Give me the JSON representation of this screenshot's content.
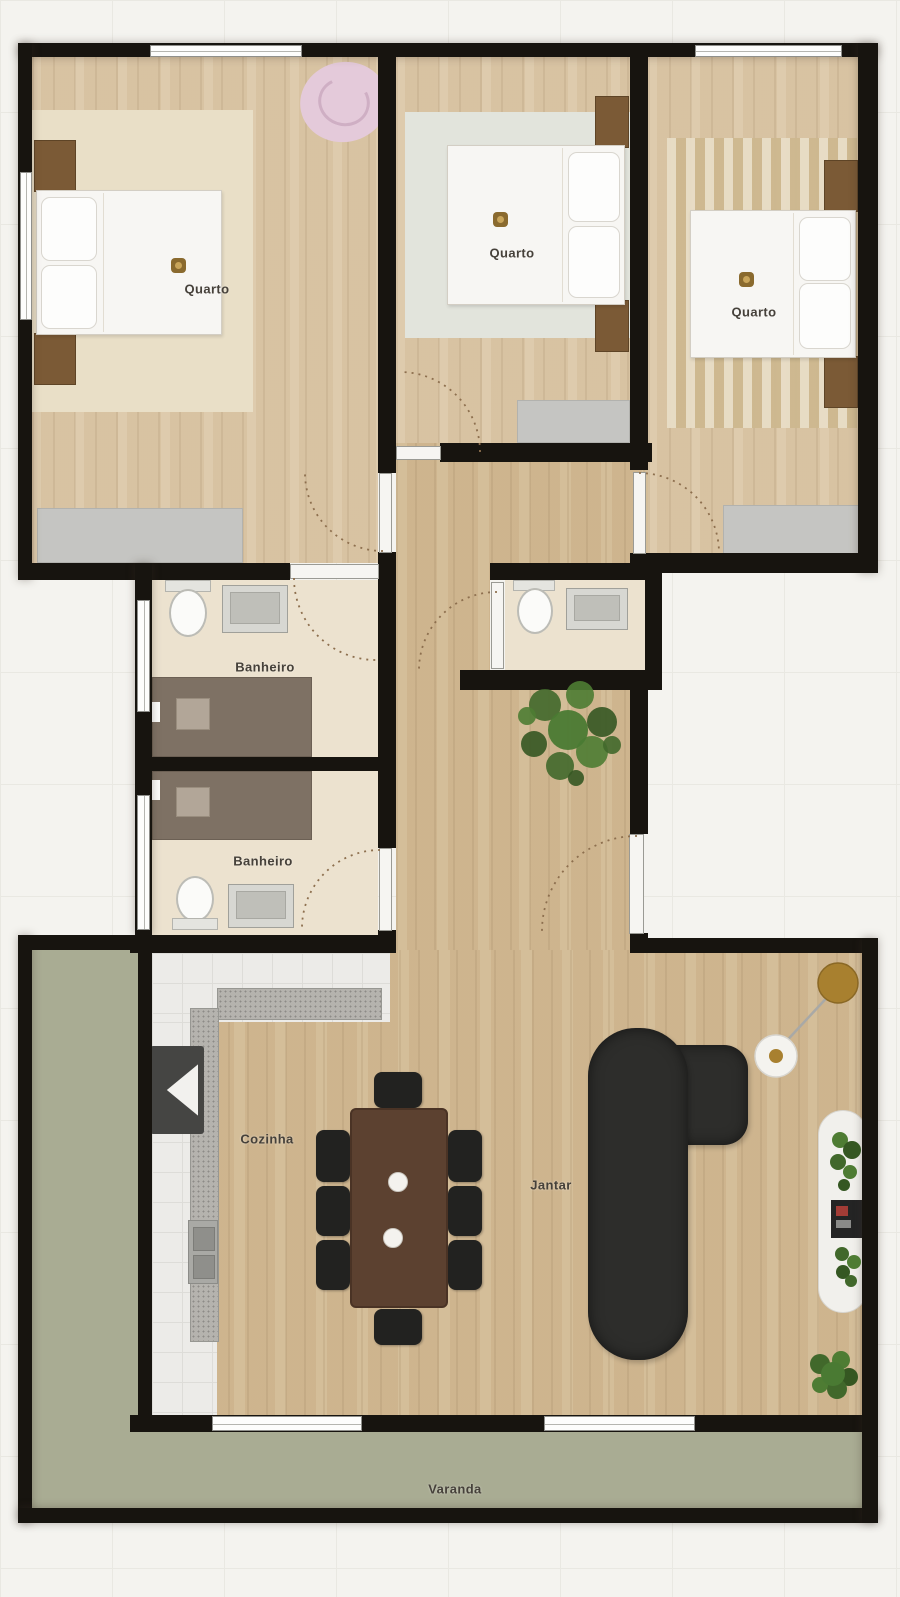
{
  "labels": {
    "bedroom_left": "Quarto",
    "bedroom_middle": "Quarto",
    "bedroom_right": "Quarto",
    "bathroom_top": "Banheiro",
    "bathroom_bottom": "Banheiro",
    "kitchen": "Cozinha",
    "dining": "Jantar",
    "balcony": "Varanda"
  },
  "colors": {
    "wall": "#17140f",
    "bedroom_floor": "#dcc8a8",
    "hall_living_floor": "#d2ba94",
    "bathroom_floor": "#ece2cf",
    "kitchen_tile": "#ecebe8",
    "balcony": "#a9ac93",
    "sofa": "#2d2d2b",
    "dining_table": "#5c4130",
    "shower": "#7e7164",
    "plant": "#4a7a33",
    "pink_rug": "#e4cada",
    "label_text": "#46413a"
  },
  "furniture": {
    "bedroom_left": [
      "double-bed",
      "nightstand-pair",
      "ceiling-light",
      "area-rug",
      "round-pink-rug",
      "wardrobe"
    ],
    "bedroom_middle": [
      "double-bed",
      "nightstand-pair",
      "ceiling-light",
      "area-rug",
      "wardrobe"
    ],
    "bedroom_right": [
      "double-bed",
      "nightstand-pair",
      "ceiling-light",
      "striped-rug",
      "wardrobe"
    ],
    "bathroom_top": [
      "toilet",
      "vanity-sink",
      "shower"
    ],
    "bathroom_bottom": [
      "toilet",
      "vanity-sink",
      "shower"
    ],
    "powder_room": [
      "toilet",
      "vanity-sink"
    ],
    "hallway": [
      "potted-plant",
      "entrance-door"
    ],
    "kitchen": [
      "l-shaped-counter",
      "kitchen-sink",
      "cooktop"
    ],
    "living_dining": [
      "dining-table",
      "eight-chairs",
      "sectional-sofa",
      "floor-lamp",
      "side-table",
      "tv-console",
      "tv",
      "potted-plants"
    ]
  }
}
